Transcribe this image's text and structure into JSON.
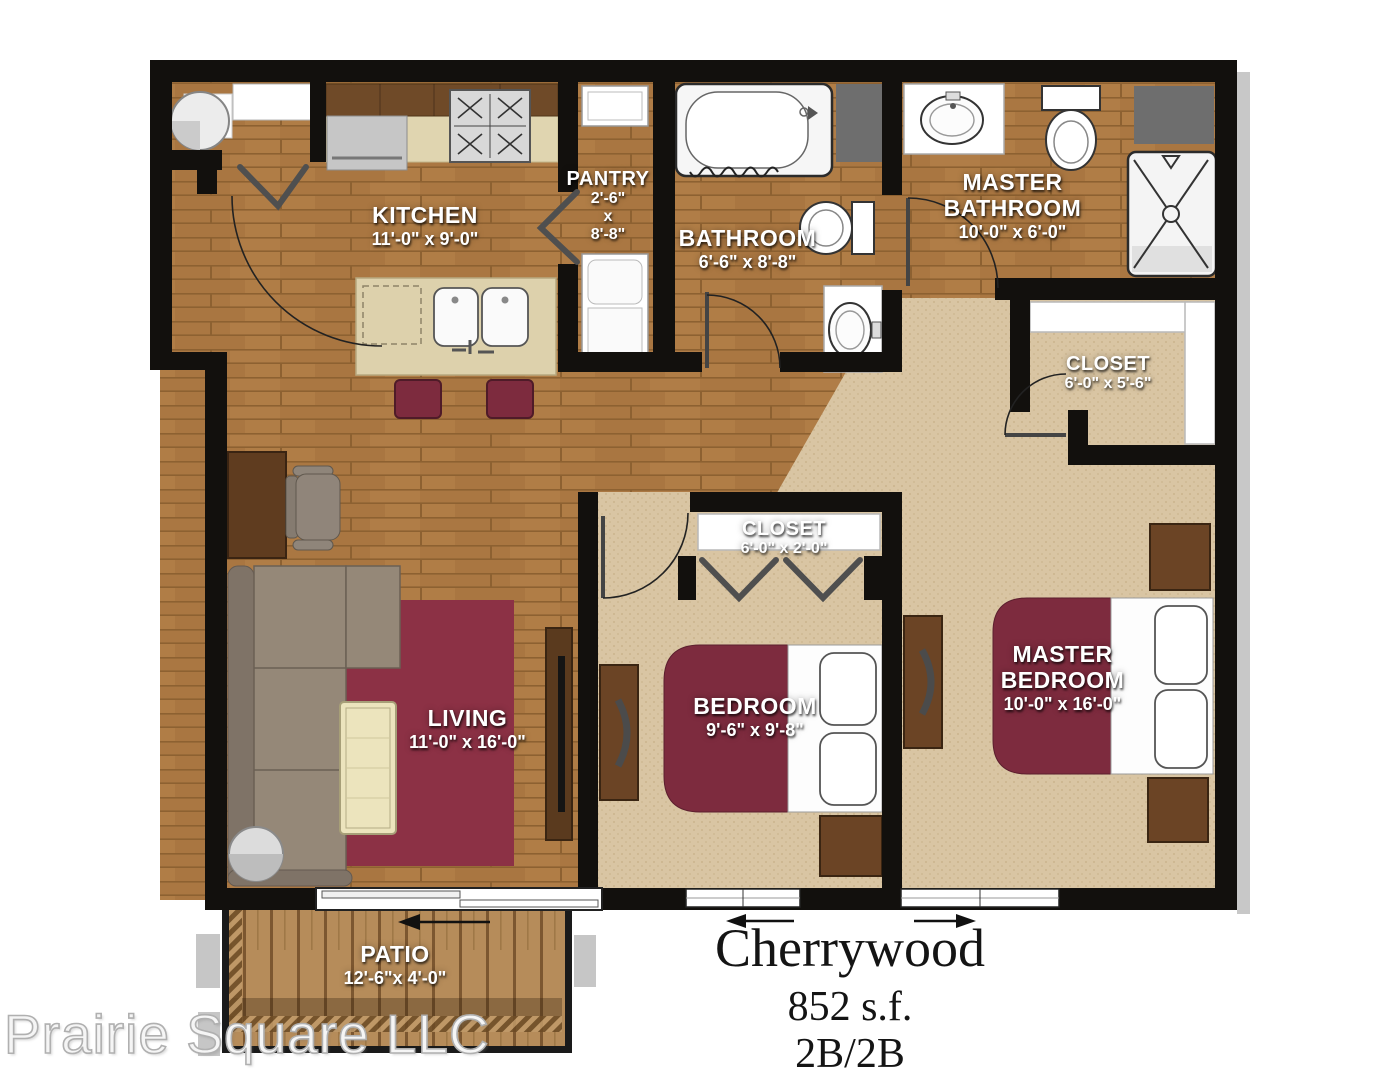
{
  "plan_title": {
    "name": "Cherrywood",
    "area": "852 s.f.",
    "layout": "2B/2B"
  },
  "watermark": "Prairie Square LLC",
  "rooms": [
    {
      "key": "kitchen",
      "label": "KITCHEN",
      "dims": "11'-0\" x 9'-0\""
    },
    {
      "key": "pantry",
      "label": "PANTRY",
      "dims_lines": [
        "2'-6\"",
        "x",
        "8'-8\""
      ]
    },
    {
      "key": "bathroom",
      "label": "BATHROOM",
      "dims": "6'-6\" x 8'-8\""
    },
    {
      "key": "master-bathroom",
      "label": "MASTER BATHROOM",
      "dims": "10'-0\" x 6'-0\""
    },
    {
      "key": "master-closet",
      "label": "CLOSET",
      "dims": "6'-0\" x 5'-6\""
    },
    {
      "key": "hall-closet",
      "label": "CLOSET",
      "dims": "6'-0\" x 2'-0\""
    },
    {
      "key": "living",
      "label": "LIVING",
      "dims": "11'-0\" x 16'-0\""
    },
    {
      "key": "bedroom",
      "label": "BEDROOM",
      "dims": "9'-6\" x 9'-8\""
    },
    {
      "key": "master-bedroom",
      "label": "MASTER BEDROOM",
      "dims": "10'-0\" x 16'-0\""
    },
    {
      "key": "patio",
      "label": "PATIO",
      "dims": "12'-6\"x 4'-0\""
    }
  ],
  "colors": {
    "wall": "#12100d",
    "wood_floor": "#ad7a43",
    "carpet": "#d9c5a3",
    "rug": "#8c3145",
    "bed_accent": "#7d2b3e",
    "deck": "#b68c5a",
    "fixture_white": "#f7f7f7",
    "furniture_wood": "#6b4425",
    "sofa": "#958878"
  }
}
